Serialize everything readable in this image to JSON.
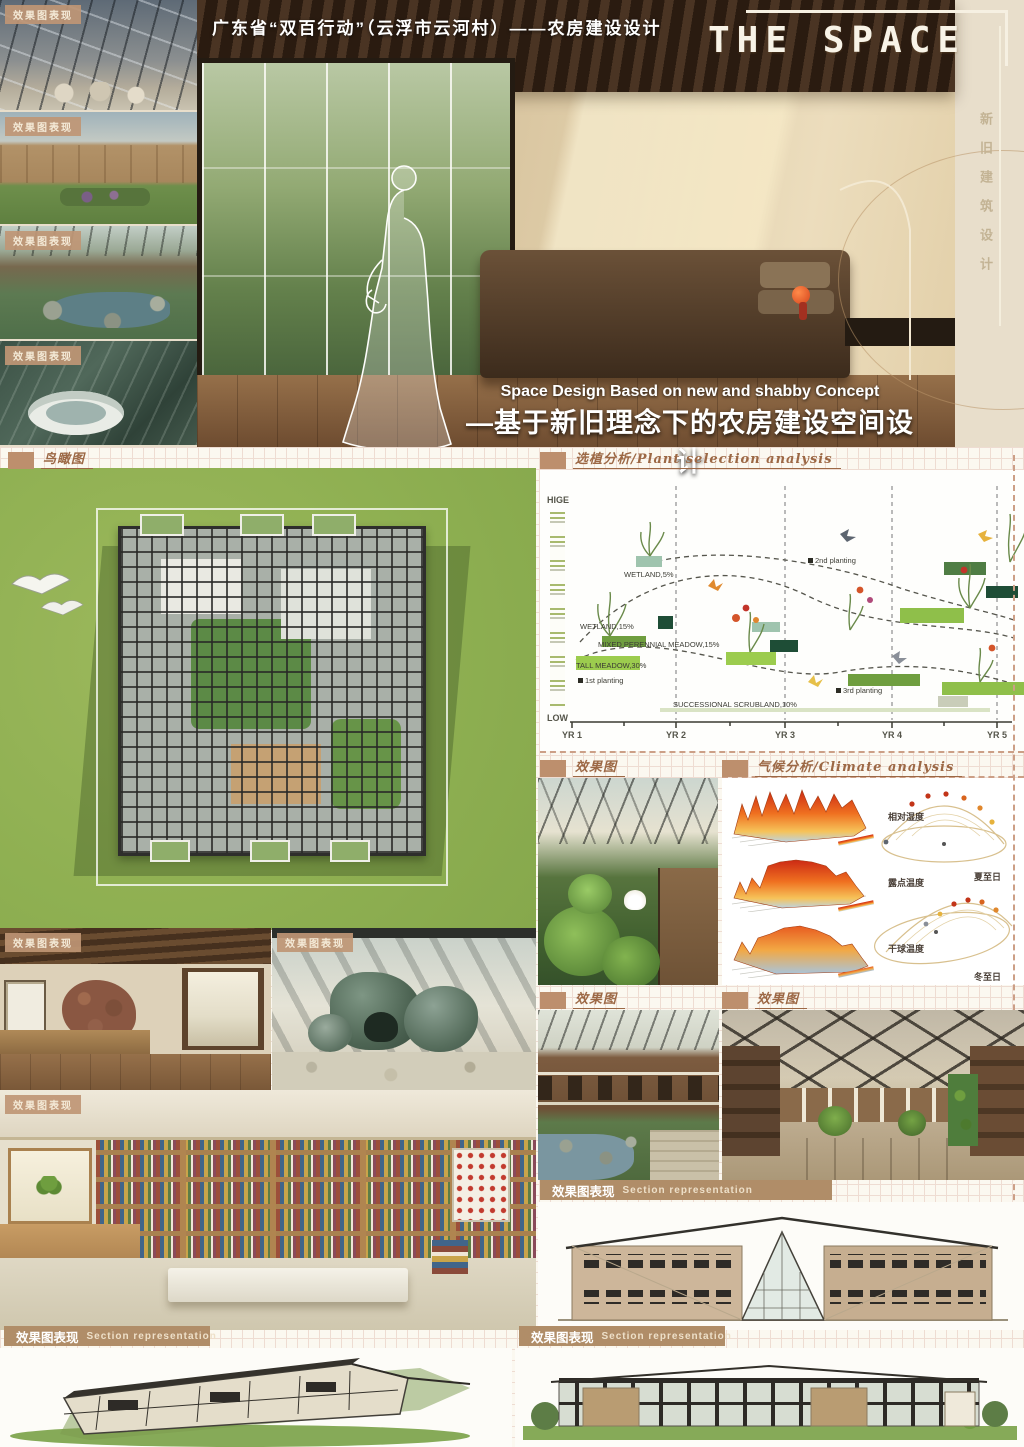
{
  "header": {
    "title": "广东省“双百行动”（云浮市云河村）——农房建设设计",
    "logo": "THE SPACE",
    "vertical_tagline": "新旧建筑设计",
    "subtitle_en": "Space Design Based on new and shabby Concept",
    "subtitle_zh": "—基于新旧理念下的农房建设空间设计"
  },
  "labels": {
    "render_badge": "效果图表现",
    "section_birdseye": "鸟瞰图",
    "section_plant": "选植分析/Plant selection analysis",
    "section_render": "效果图",
    "section_climate": "气候分析/Climate analysis",
    "section_bar_zh": "效果图表现",
    "section_bar_en": "Section representation"
  },
  "chart_data": {
    "type": "scatter",
    "title": "选植分析/Plant selection analysis",
    "x_ticks": [
      "YR 1",
      "YR 2",
      "YR 3",
      "YR 4",
      "YR 5"
    ],
    "y_top": "HIGE",
    "y_bottom": "LOW",
    "series": [
      {
        "name": "WETLAND,5%",
        "value_pct": 5
      },
      {
        "name": "WETLAND,15%",
        "value_pct": 15
      },
      {
        "name": "MIXED PERENNIAL MEADOW,15%",
        "value_pct": 15
      },
      {
        "name": "TALL MEADOW,30%",
        "value_pct": 30
      },
      {
        "name": "SUCCESSIONAL SCRUBLAND,10%",
        "value_pct": 10
      }
    ],
    "planting_markers": [
      "1st planting",
      "2nd planting",
      "3rd planting"
    ],
    "legend_position": "inline",
    "grid": false
  },
  "climate": {
    "surface_plots": [
      "相对湿度",
      "露点温度",
      "干球温度"
    ],
    "sun_diagrams": [
      "夏至日",
      "冬至日"
    ]
  },
  "colors": {
    "poster_bg": "#e8decb",
    "badge_bg": "#bf9675",
    "section_text": "#9c6845",
    "bar_bg": "#b08d68",
    "lawn_green": "#96b257",
    "accent_dark_green": "#1e4d36",
    "accent_light_green": "#9ccc4e",
    "heat_orange": "#e85c20"
  }
}
